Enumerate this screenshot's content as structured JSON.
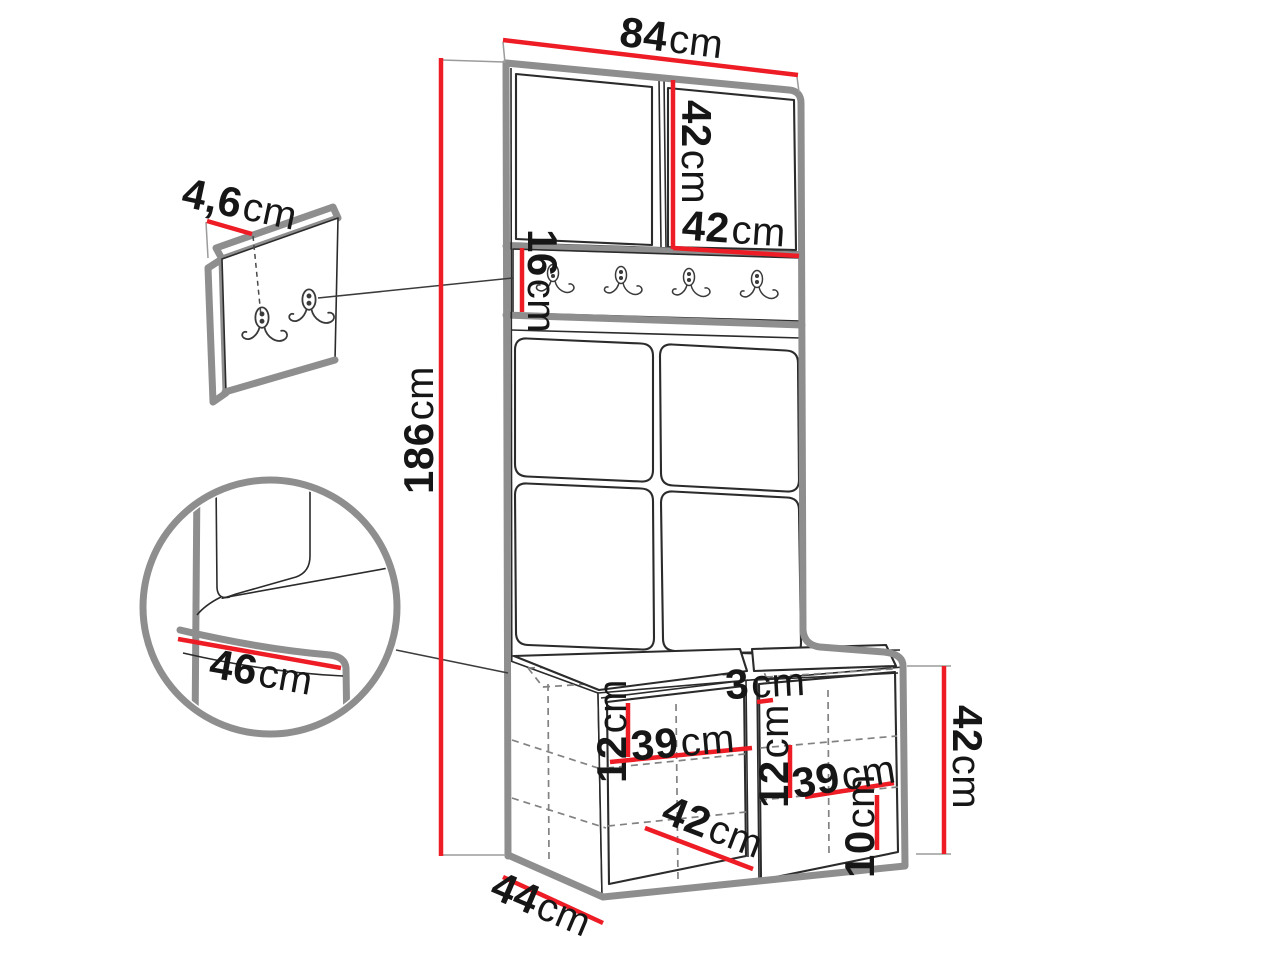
{
  "diagram": {
    "colors": {
      "dimension_line": "#ee1c25",
      "outline": "#8e8e8e",
      "sketch_line": "#2b2b2b",
      "hidden_line": "#828282",
      "label_text": "#161616",
      "background": "#ffffff"
    },
    "icons": {
      "hook": "double-coat-hook-icon",
      "detail_circle": "corner-detail-magnifier"
    },
    "dims": {
      "total_width": {
        "value": "84",
        "unit": "cm"
      },
      "upper_panel_height": {
        "value": "42",
        "unit": "cm"
      },
      "upper_panel_width": {
        "value": "42",
        "unit": "cm"
      },
      "hook_rail_height": {
        "value": "16",
        "unit": "cm"
      },
      "total_height": {
        "value": "186",
        "unit": "cm"
      },
      "wall_panel_thickness": {
        "value": "4,6",
        "unit": "cm"
      },
      "seat_depth_detail": {
        "value": "46",
        "unit": "cm"
      },
      "left_shelf_gap": {
        "value": "12",
        "unit": "cm"
      },
      "left_shelf_width": {
        "value": "39",
        "unit": "cm"
      },
      "seat_gap": {
        "value": "3",
        "unit": "cm"
      },
      "right_shelf_gap": {
        "value": "12",
        "unit": "cm"
      },
      "right_shelf_width": {
        "value": "39",
        "unit": "cm"
      },
      "bench_inner_width": {
        "value": "42",
        "unit": "cm"
      },
      "bottom_shelf_gap": {
        "value": "10",
        "unit": "cm"
      },
      "bench_depth": {
        "value": "44",
        "unit": "cm"
      },
      "bench_height": {
        "value": "42",
        "unit": "cm"
      }
    }
  }
}
